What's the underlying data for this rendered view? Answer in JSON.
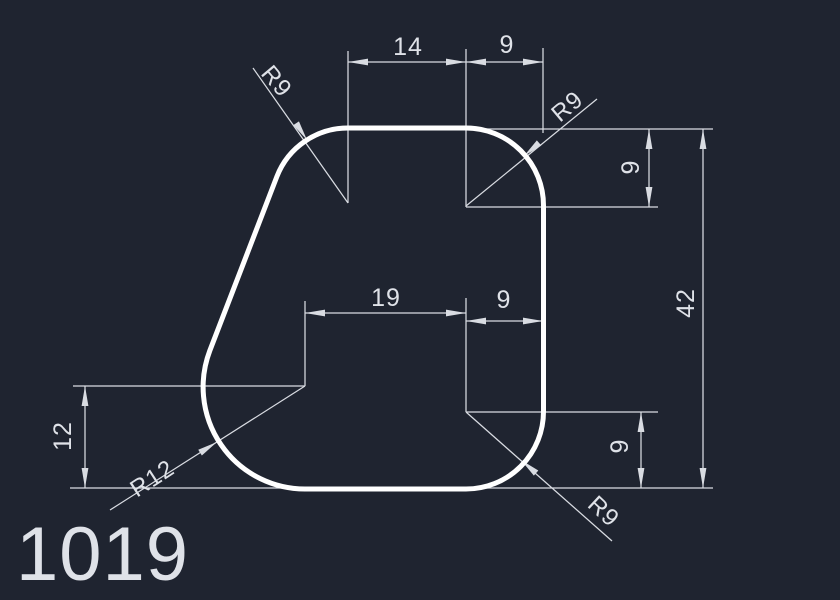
{
  "app": {
    "background_color": "#1f2430",
    "line_color": "#d9dce2",
    "text_color": "#dfe2e8",
    "shape_color": "#ffffff"
  },
  "drawing": {
    "part_number": "1019",
    "dims": {
      "top_left_width": "14",
      "top_right_width": "9",
      "right_corner_height": "9",
      "overall_height": "42",
      "mid_left_width": "19",
      "mid_right_width": "9",
      "left_bottom_height": "12",
      "right_bottom_height": "9"
    },
    "radius_labels": {
      "top_left": "R9",
      "top_right": "R9",
      "bottom_left": "R12",
      "bottom_right": "R9"
    }
  }
}
